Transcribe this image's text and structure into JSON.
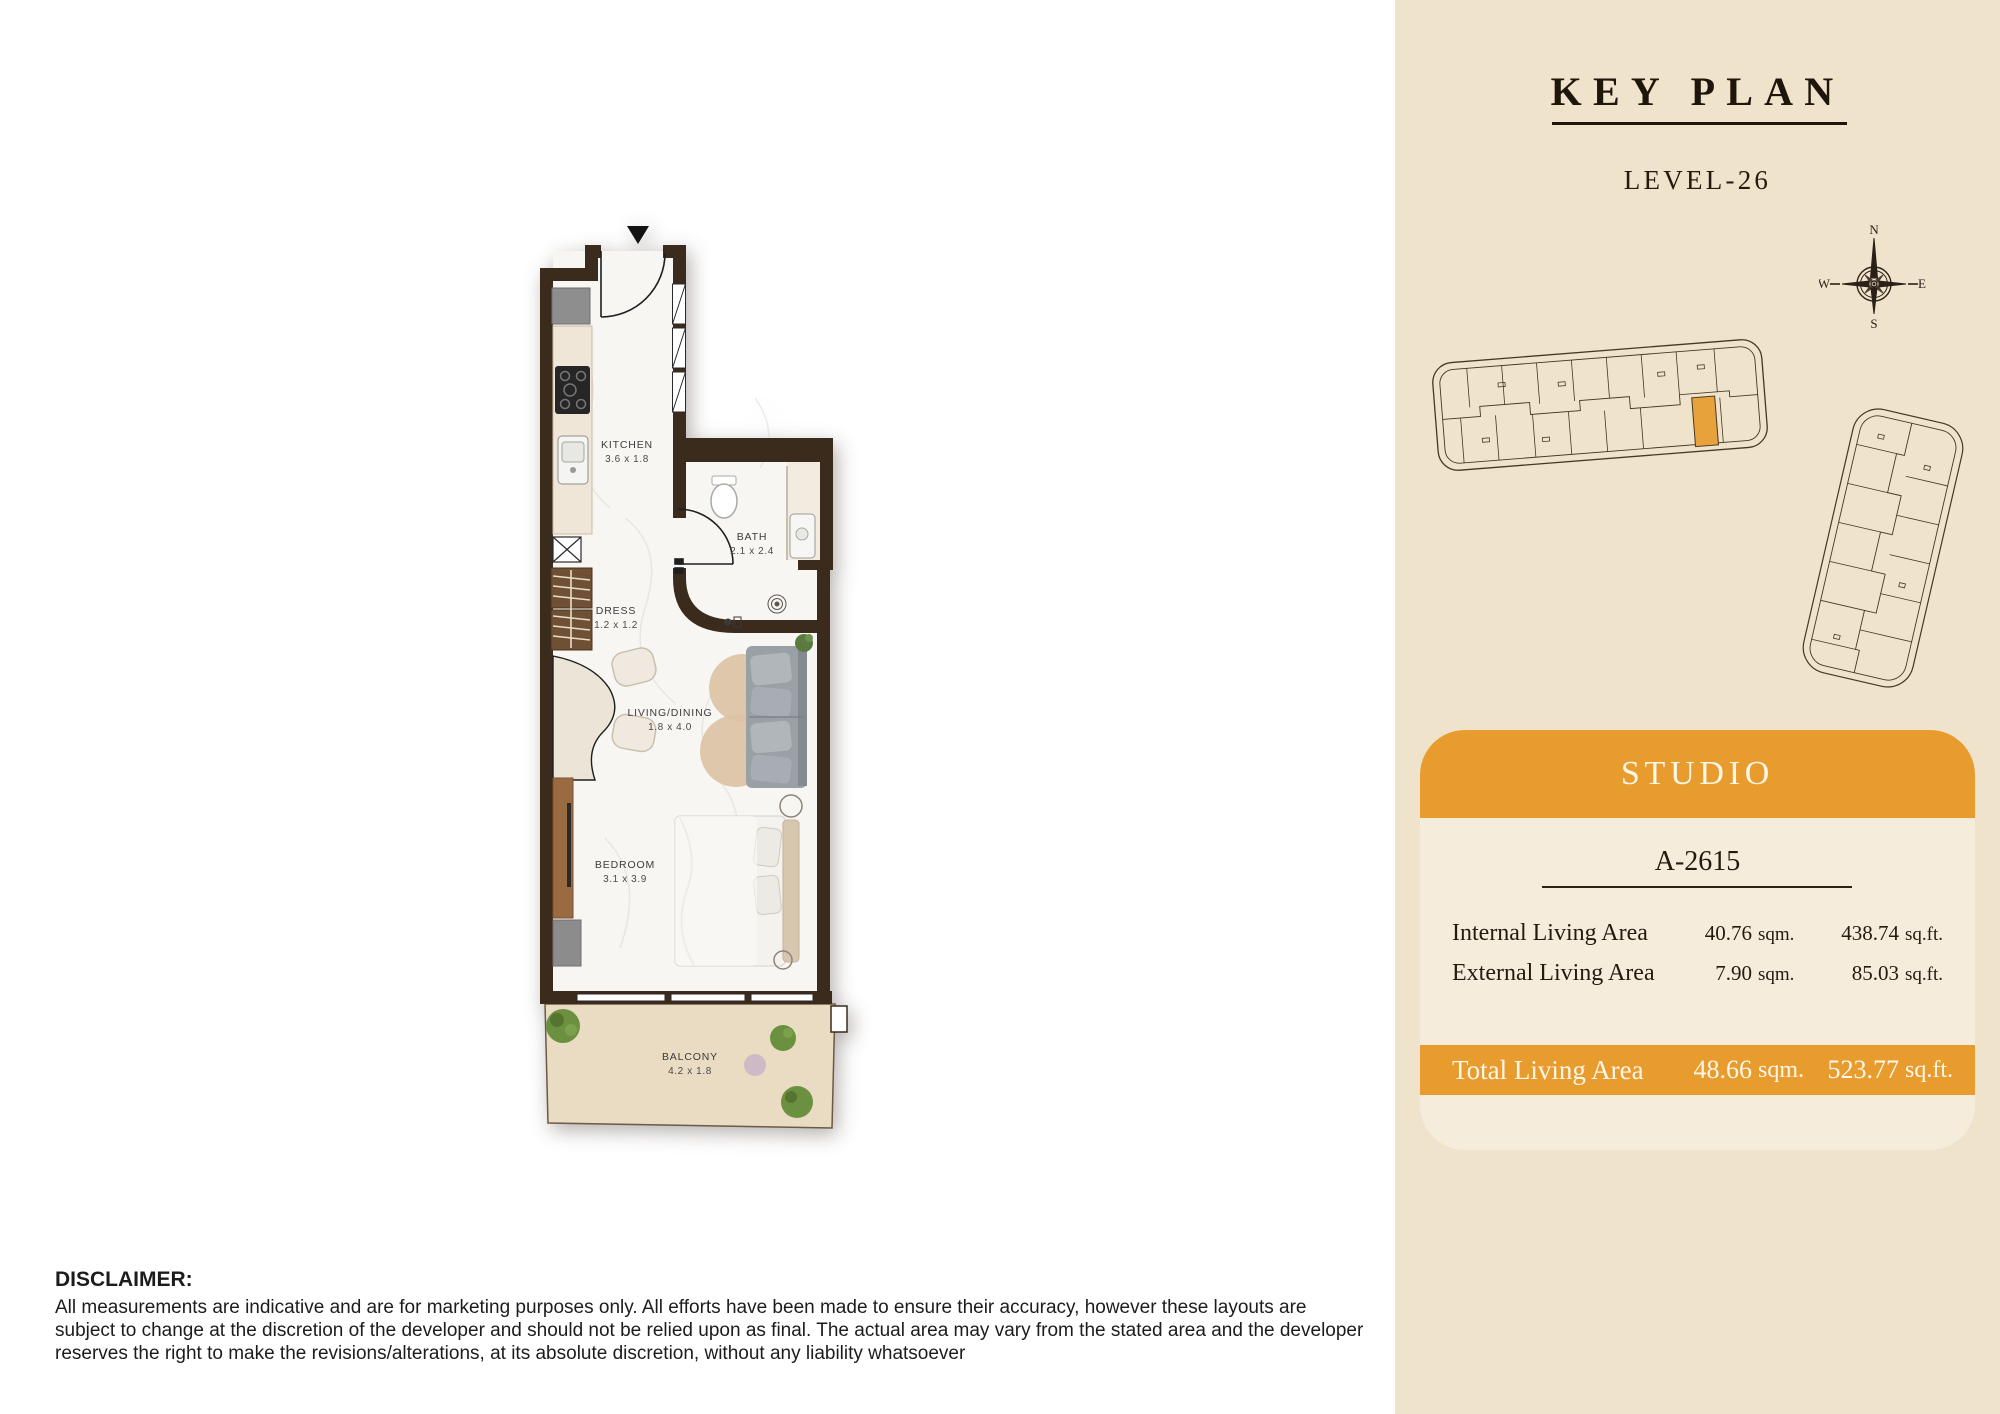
{
  "key_plan": {
    "title": "KEY PLAN",
    "level": "LEVEL-26",
    "compass": {
      "n": "N",
      "e": "E",
      "s": "S",
      "w": "W"
    }
  },
  "unit_card": {
    "type_label": "STUDIO",
    "unit_number": "A-2615",
    "rows": [
      {
        "label": "Internal Living Area",
        "sqm": "40.76",
        "sqm_unit": "sqm.",
        "sqft": "438.74",
        "sqft_unit": "sq.ft."
      },
      {
        "label": "External Living Area",
        "sqm": "7.90",
        "sqm_unit": "sqm.",
        "sqft": "85.03",
        "sqft_unit": "sq.ft."
      }
    ],
    "total": {
      "label": "Total Living Area",
      "sqm": "48.66",
      "sqm_unit": "sqm.",
      "sqft": "523.77",
      "sqft_unit": "sq.ft."
    }
  },
  "floor_plan": {
    "rooms": [
      {
        "name": "KITCHEN",
        "dim": "3.6 x 1.8"
      },
      {
        "name": "BATH",
        "dim": "2.1 x 2.4"
      },
      {
        "name": "DRESS",
        "dim": "1.2 x 1.2"
      },
      {
        "name": "LIVING/DINING",
        "dim": "1.8 x 4.0"
      },
      {
        "name": "BEDROOM",
        "dim": "3.1 x 3.9"
      },
      {
        "name": "BALCONY",
        "dim": "4.2 x 1.8"
      }
    ]
  },
  "disclaimer": {
    "heading": "DISCLAIMER:",
    "body": "All measurements are indicative and are for marketing purposes only. All efforts have been made to ensure their accuracy, however these layouts are subject to change at the discretion of the developer and should not be relied upon as final. The actual area may vary from the stated area and the developer reserves the right to make the revisions/alterations, at its absolute discretion, without any liability whatsoever"
  },
  "colors": {
    "accent_orange": "#e89c2e",
    "panel_beige": "#f0e3cb",
    "card_cream": "#f5ecdc",
    "wall_brown": "#3b2b1c",
    "text_dark": "#241a0e"
  }
}
